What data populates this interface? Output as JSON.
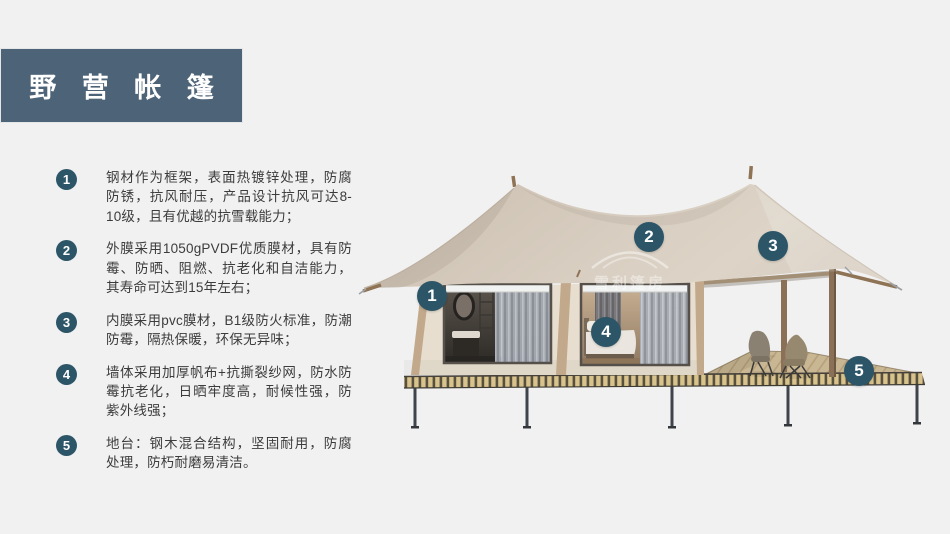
{
  "title": "野 营 帐 篷",
  "features": [
    {
      "num": "1",
      "text": "钢材作为框架，表面热镀锌处理，防腐防锈，抗风耐压，产品设计抗风可达8-10级，且有优越的抗雪载能力；"
    },
    {
      "num": "2",
      "text": "外膜采用1050gPVDF优质膜材，具有防霉、防晒、阻燃、抗老化和自洁能力，其寿命可达到15年左右；"
    },
    {
      "num": "3",
      "text": "内膜采用pvc膜材，B1级防火标准，防潮防霉，隔热保暖，环保无异味；"
    },
    {
      "num": "4",
      "text": "墙体采用加厚帆布+抗撕裂纱网，防水防霉抗老化，日晒牢度高，耐候性强，防紫外线强；"
    },
    {
      "num": "5",
      "text": "地台：钢木混合结构，坚固耐用，防腐处理，防朽耐磨易清洁。"
    }
  ],
  "callouts": [
    {
      "num": "1",
      "target": "steel-frame"
    },
    {
      "num": "2",
      "target": "outer-membrane"
    },
    {
      "num": "3",
      "target": "inner-membrane"
    },
    {
      "num": "4",
      "target": "wall-fabric"
    },
    {
      "num": "5",
      "target": "platform"
    }
  ],
  "watermark": {
    "text": "雪利篷房"
  },
  "colors": {
    "background": "#f1f1f2",
    "title_bar": "#4d6377",
    "badge": "#2d5568",
    "canopy": "#d5cabd",
    "wall": "#e7decf",
    "deck_slat": "#d9c38c"
  }
}
